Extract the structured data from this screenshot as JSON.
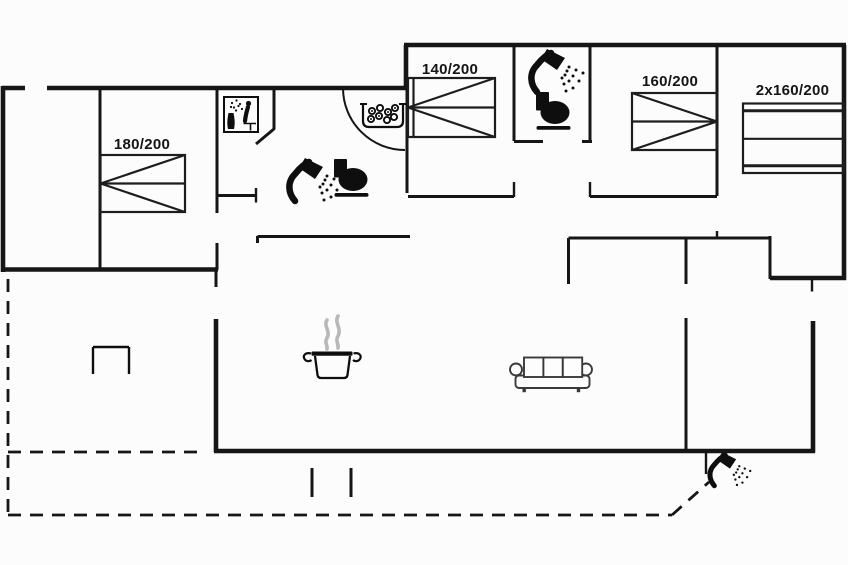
{
  "plan": {
    "colors": {
      "background": "#fcfcfc",
      "wall": "#161616",
      "icon": "#0e0e0e",
      "furniture": "#1d1d1d",
      "sofa": "#3a3a3a",
      "steam": "#b8b8b8"
    },
    "beds": [
      {
        "name": "double-bed",
        "label": "180/200"
      },
      {
        "name": "double-bed",
        "label": "140/200"
      },
      {
        "name": "double-bed",
        "label": "160/200"
      },
      {
        "name": "bunk-bed",
        "label": "2x160/200"
      }
    ],
    "icons": [
      {
        "name": "sauna-icon"
      },
      {
        "name": "whirlpool-icon"
      },
      {
        "name": "shower-icon",
        "location": "bathroom-1"
      },
      {
        "name": "toilet-icon",
        "location": "bathroom-1"
      },
      {
        "name": "shower-icon",
        "location": "bathroom-2"
      },
      {
        "name": "toilet-icon",
        "location": "bathroom-2"
      },
      {
        "name": "cooking-pot-icon",
        "location": "kitchen"
      },
      {
        "name": "sofa-icon",
        "location": "living-room"
      },
      {
        "name": "outdoor-shower-icon",
        "location": "terrace"
      },
      {
        "name": "table-icon",
        "location": "terrace"
      }
    ]
  }
}
